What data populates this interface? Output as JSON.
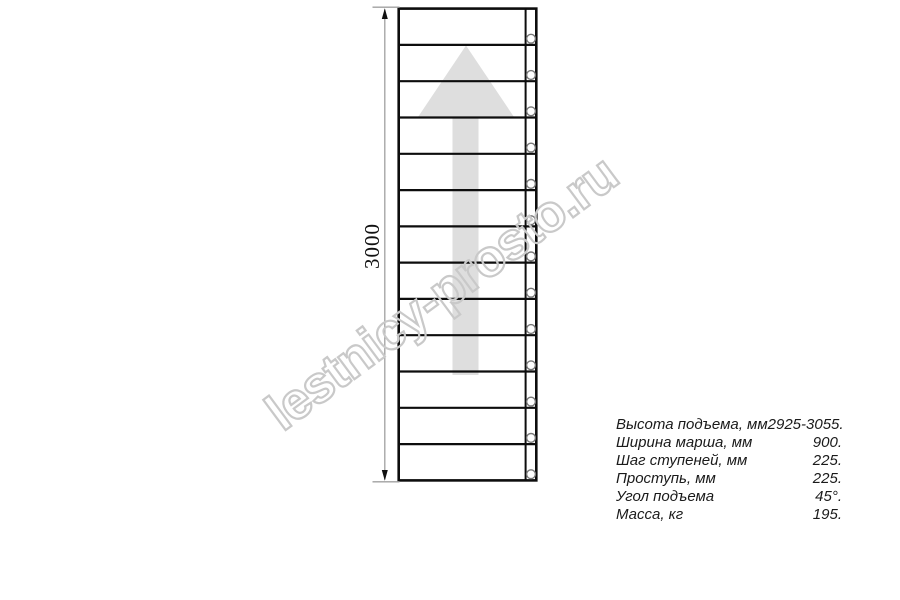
{
  "drawing": {
    "dimension_label": "3000",
    "treads": 13,
    "watermark_text": "lestnicy-prosto.ru"
  },
  "specs": {
    "rows": [
      {
        "label": "Высота подъема, мм",
        "value": "2925-3055."
      },
      {
        "label": "Ширина марша, мм",
        "value": "900."
      },
      {
        "label": "Шаг ступеней, мм",
        "value": "225."
      },
      {
        "label": "Проступь, мм",
        "value": "225."
      },
      {
        "label": "Угол подъема",
        "value": "45°."
      },
      {
        "label": "Масса, кг",
        "value": "195."
      }
    ]
  },
  "colors": {
    "line": "#0d0d0d",
    "arrow_fill": "#dedede",
    "dimension_line": "#a0a0a0",
    "hole_stroke": "#777777",
    "watermark_stroke": "#c9c9c9",
    "text": "#1a1a1a"
  }
}
